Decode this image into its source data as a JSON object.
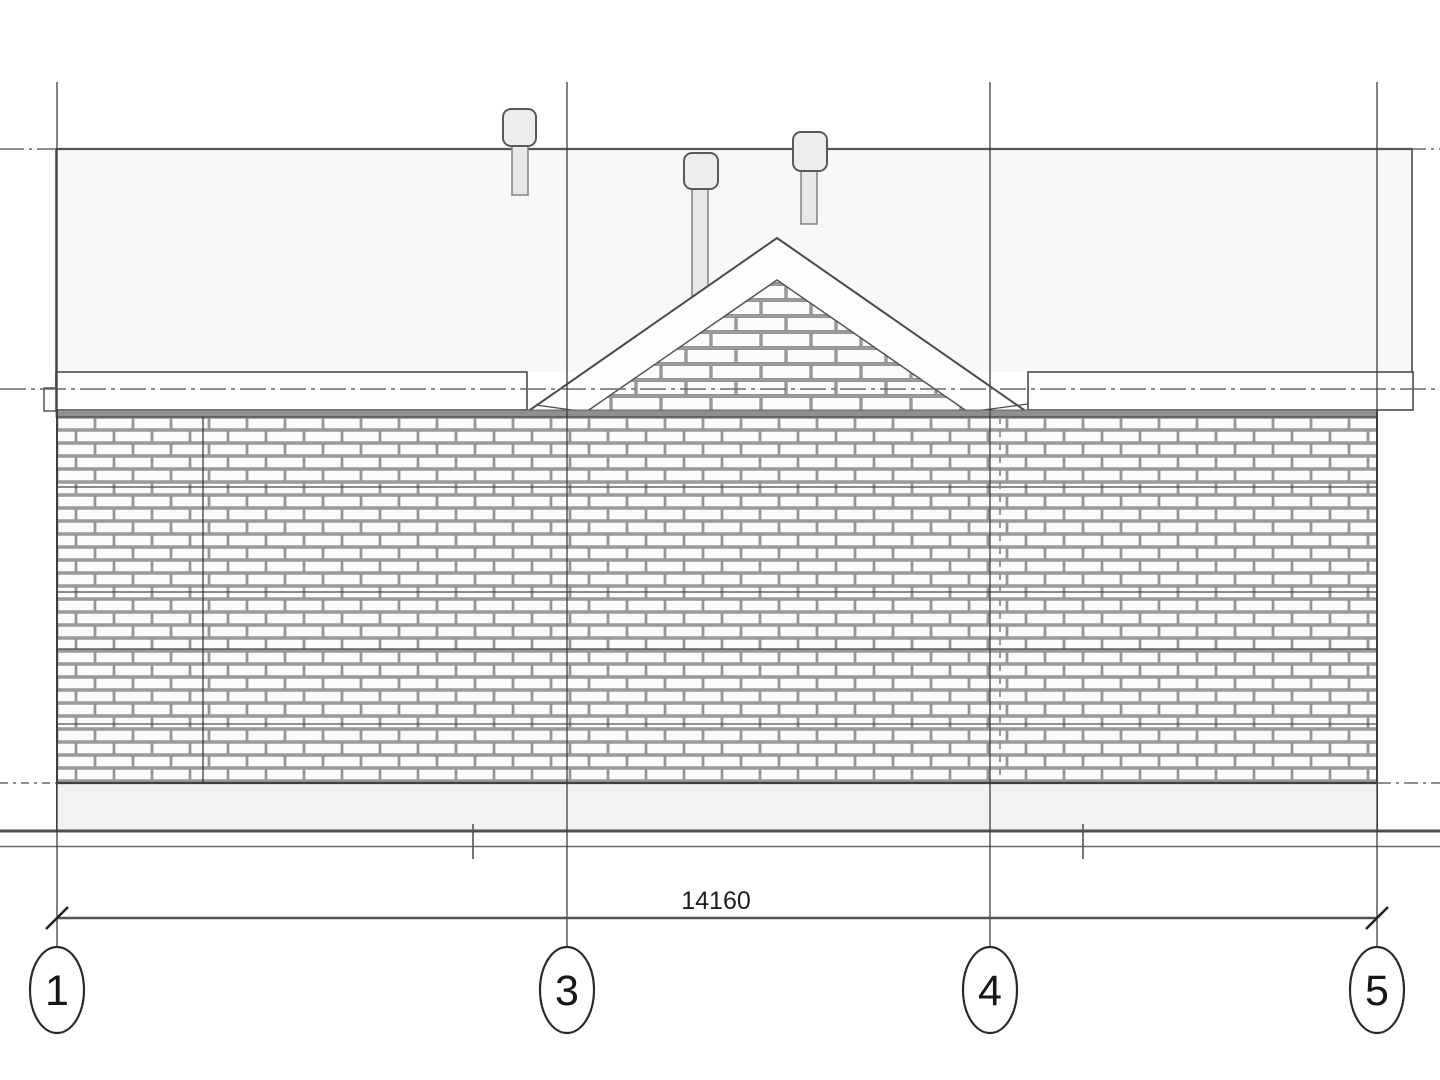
{
  "drawing": {
    "view_label": "building-front-elevation",
    "dimension": {
      "value": "14160"
    },
    "grid_bubbles": [
      {
        "label": "1"
      },
      {
        "label": "3"
      },
      {
        "label": "4"
      },
      {
        "label": "5"
      }
    ],
    "icons": {
      "roof_vent_left": "roof-vent-icon",
      "roof_vent_middle": "roof-vent-icon",
      "roof_vent_right": "roof-vent-icon"
    },
    "colors": {
      "background": "#ffffff",
      "line": "#4a4a4a",
      "level_line": "#6a6a6a",
      "mortar": "#9c9c9c",
      "brick_face": "#fbfbfb",
      "roof_fill": "#f8f8f8",
      "fascia_fill": "#fdfdfd",
      "plinth_fill": "#f2f2f2",
      "ground_line": "#4f4f4f"
    }
  }
}
